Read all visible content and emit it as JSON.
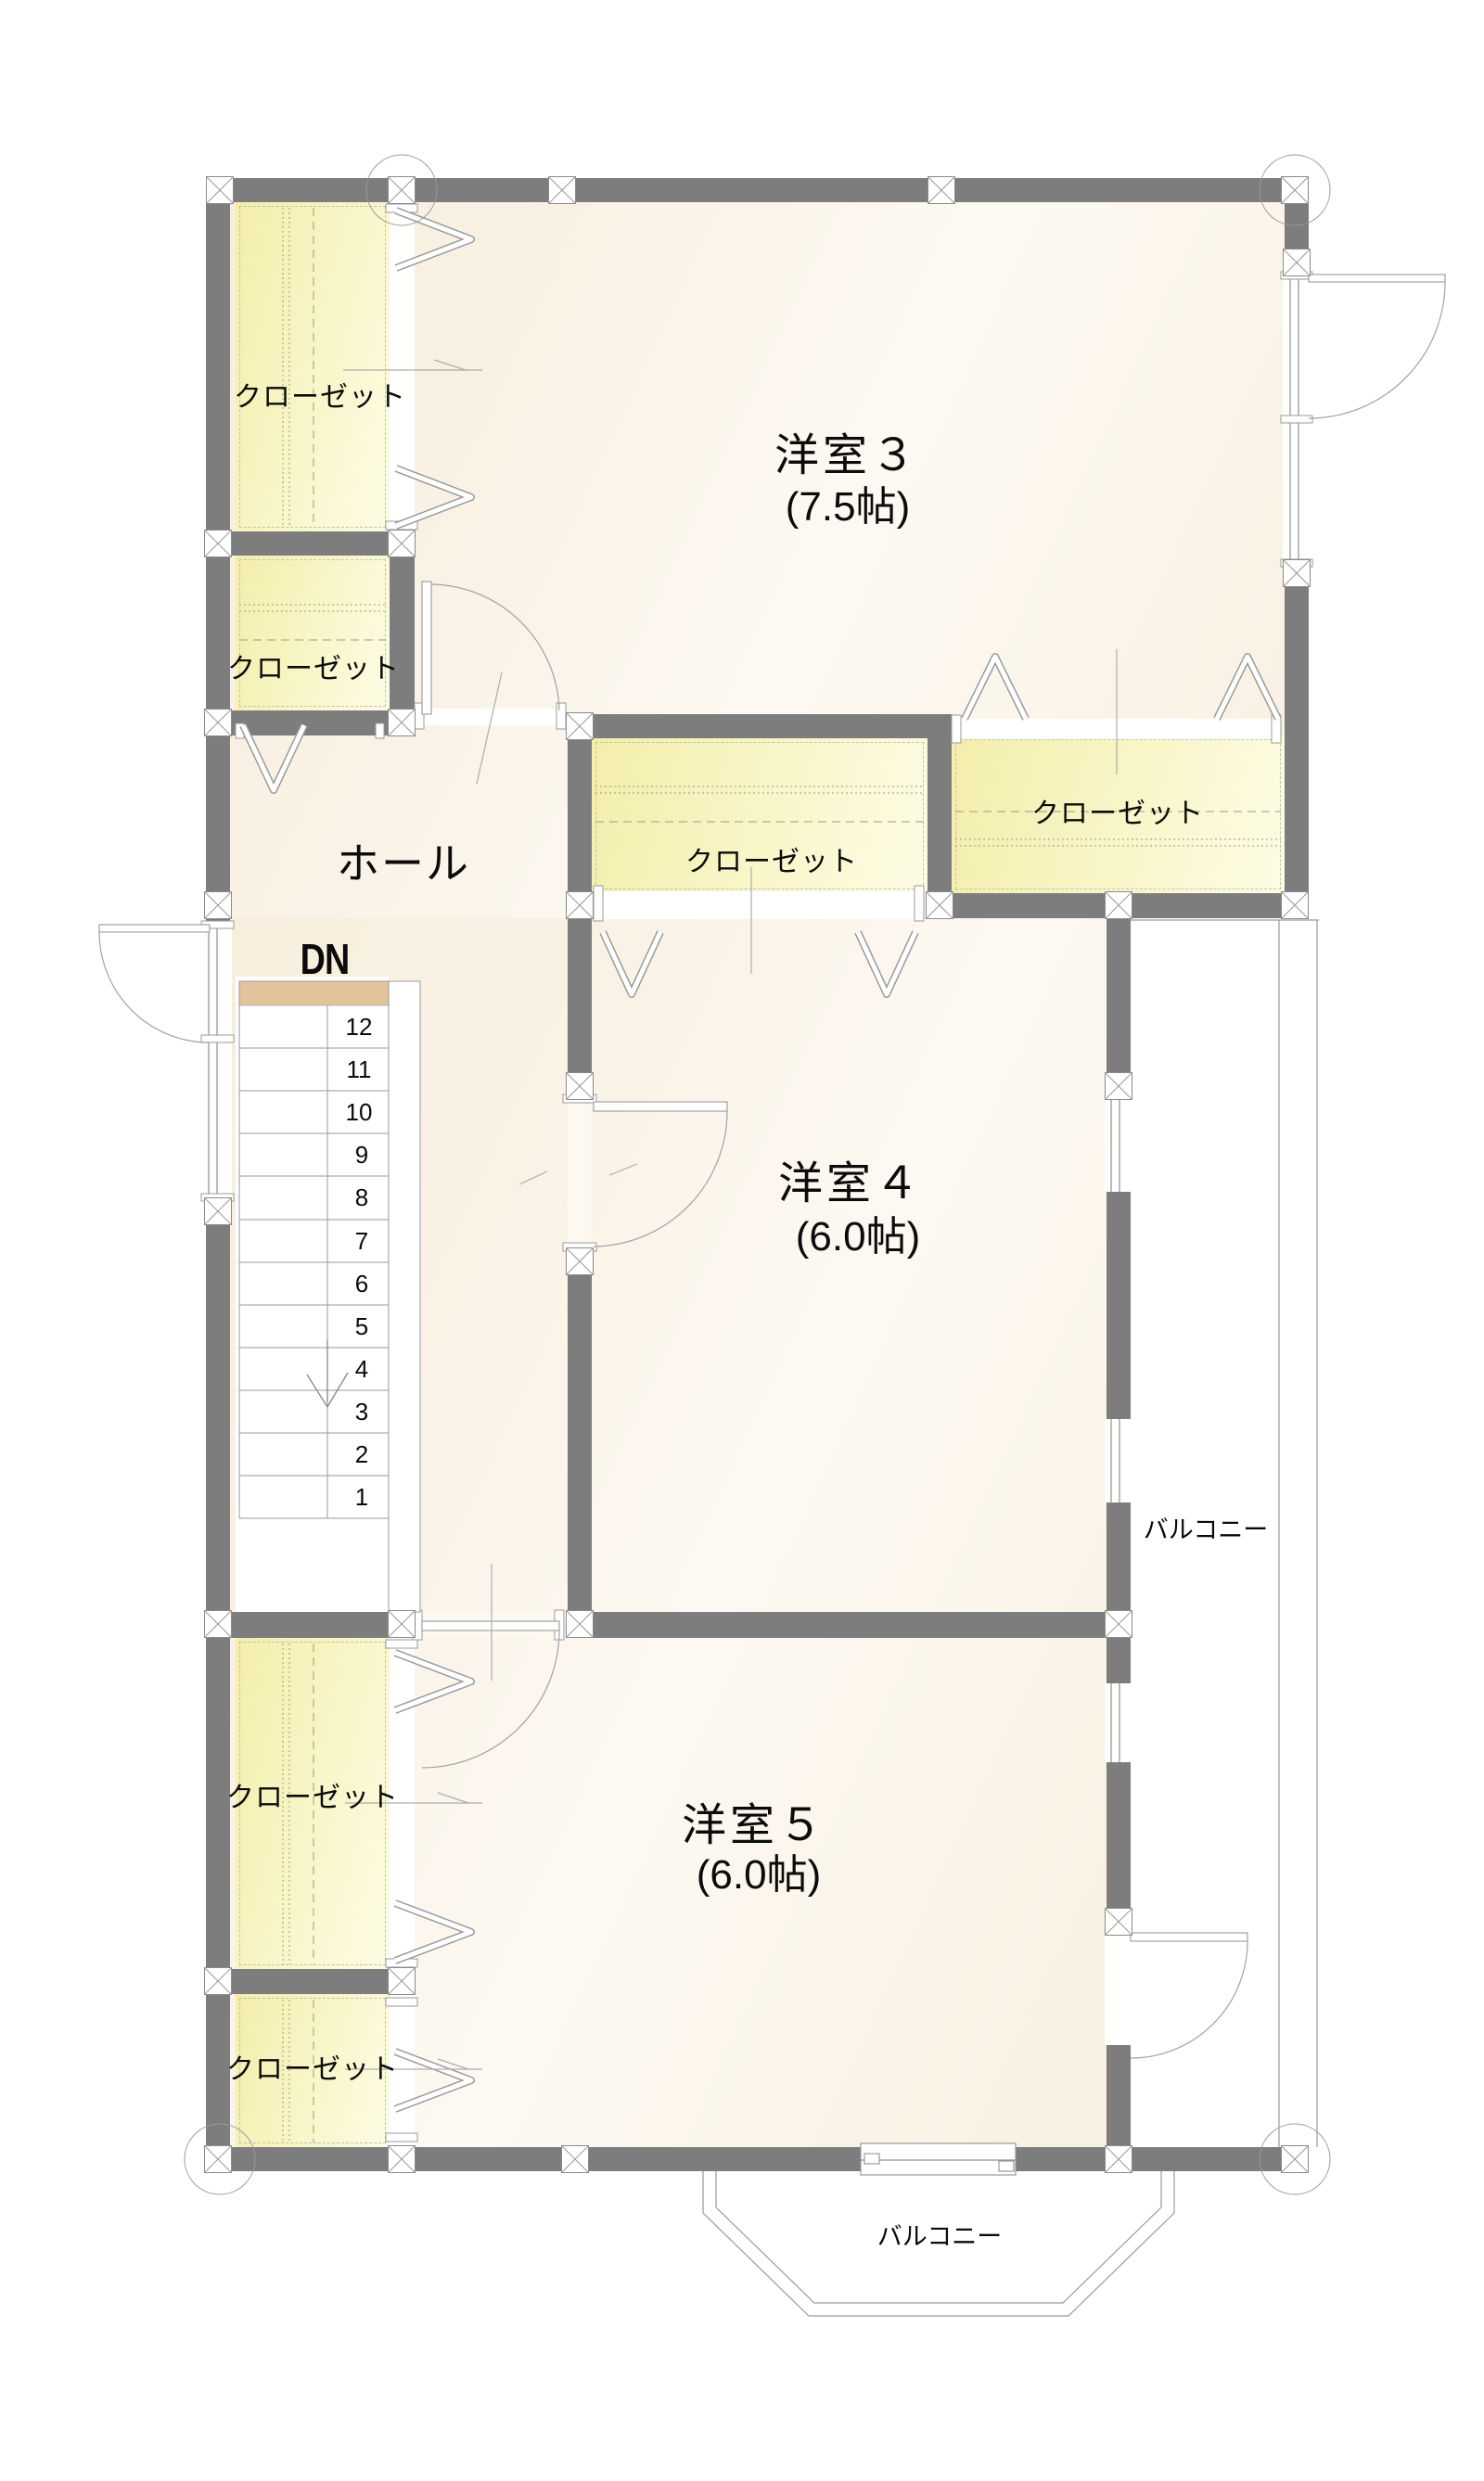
{
  "rooms": {
    "room3": {
      "name": "洋室３",
      "size": "(7.5帖)"
    },
    "room4": {
      "name": "洋室４",
      "size": "(6.0帖)"
    },
    "room5": {
      "name": "洋室５",
      "size": "(6.0帖)"
    },
    "hall": {
      "name": "ホール"
    }
  },
  "closet_label": "クローゼット",
  "stairs": {
    "direction_label": "DN",
    "steps": [
      "12",
      "11",
      "10",
      "9",
      "8",
      "7",
      "6",
      "5",
      "4",
      "3",
      "2",
      "1"
    ]
  },
  "balconies": {
    "right": "バルコニー",
    "bottom": "バルコニー"
  },
  "colors": {
    "wall": "#7d7d7d",
    "floor": "#f9f2e6",
    "closet": "#f6f1b6",
    "stair_landing": "#e2c39b",
    "thin_line": "#999999",
    "text": "#0b0b0b"
  }
}
